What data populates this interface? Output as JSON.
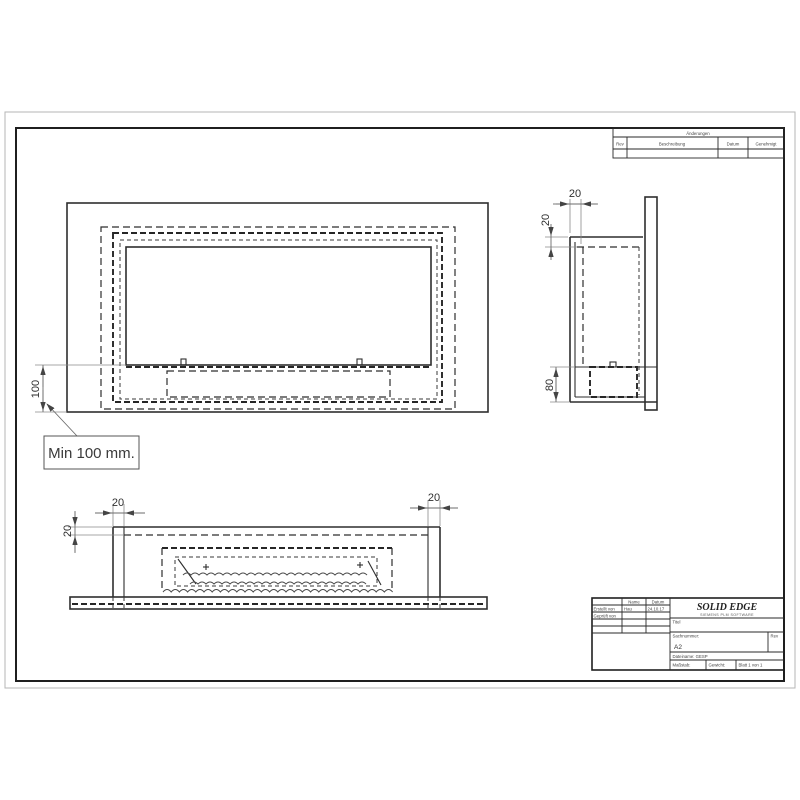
{
  "front_view": {
    "dim_height": "100",
    "note": "Min 100 mm."
  },
  "side_view": {
    "dim_depth": "20",
    "dim_top_offset": "20",
    "dim_burner_height": "80"
  },
  "bottom_view": {
    "dim_wall_left": "20",
    "dim_top_offset": "20",
    "dim_wall_right": "20"
  },
  "revision_table": {
    "title": "Änderungen",
    "columns": {
      "rev": "Rev",
      "description": "Beschreibung",
      "date": "Datum",
      "approved": "Genehmigt"
    }
  },
  "title_block": {
    "approvals": {
      "name_header": "Name",
      "date_header": "Datum",
      "created_label": "Erstellt von",
      "created_name": "Hau",
      "created_date": "24.10.17",
      "checked_label": "Geprüft von"
    },
    "logo_text": "SOLID EDGE",
    "logo_subtext": "SIEMENS PLM SOFTWARE",
    "title_label": "Titel",
    "partnumber_label": "Sachnummer:",
    "sheet_size": "A2",
    "rev_label": "Rev",
    "filename_text": "Dateiname: GESP",
    "scale_label": "Maßstab:",
    "weight_label": "Gewicht:",
    "sheet_label": "Blatt 1 von 1"
  }
}
